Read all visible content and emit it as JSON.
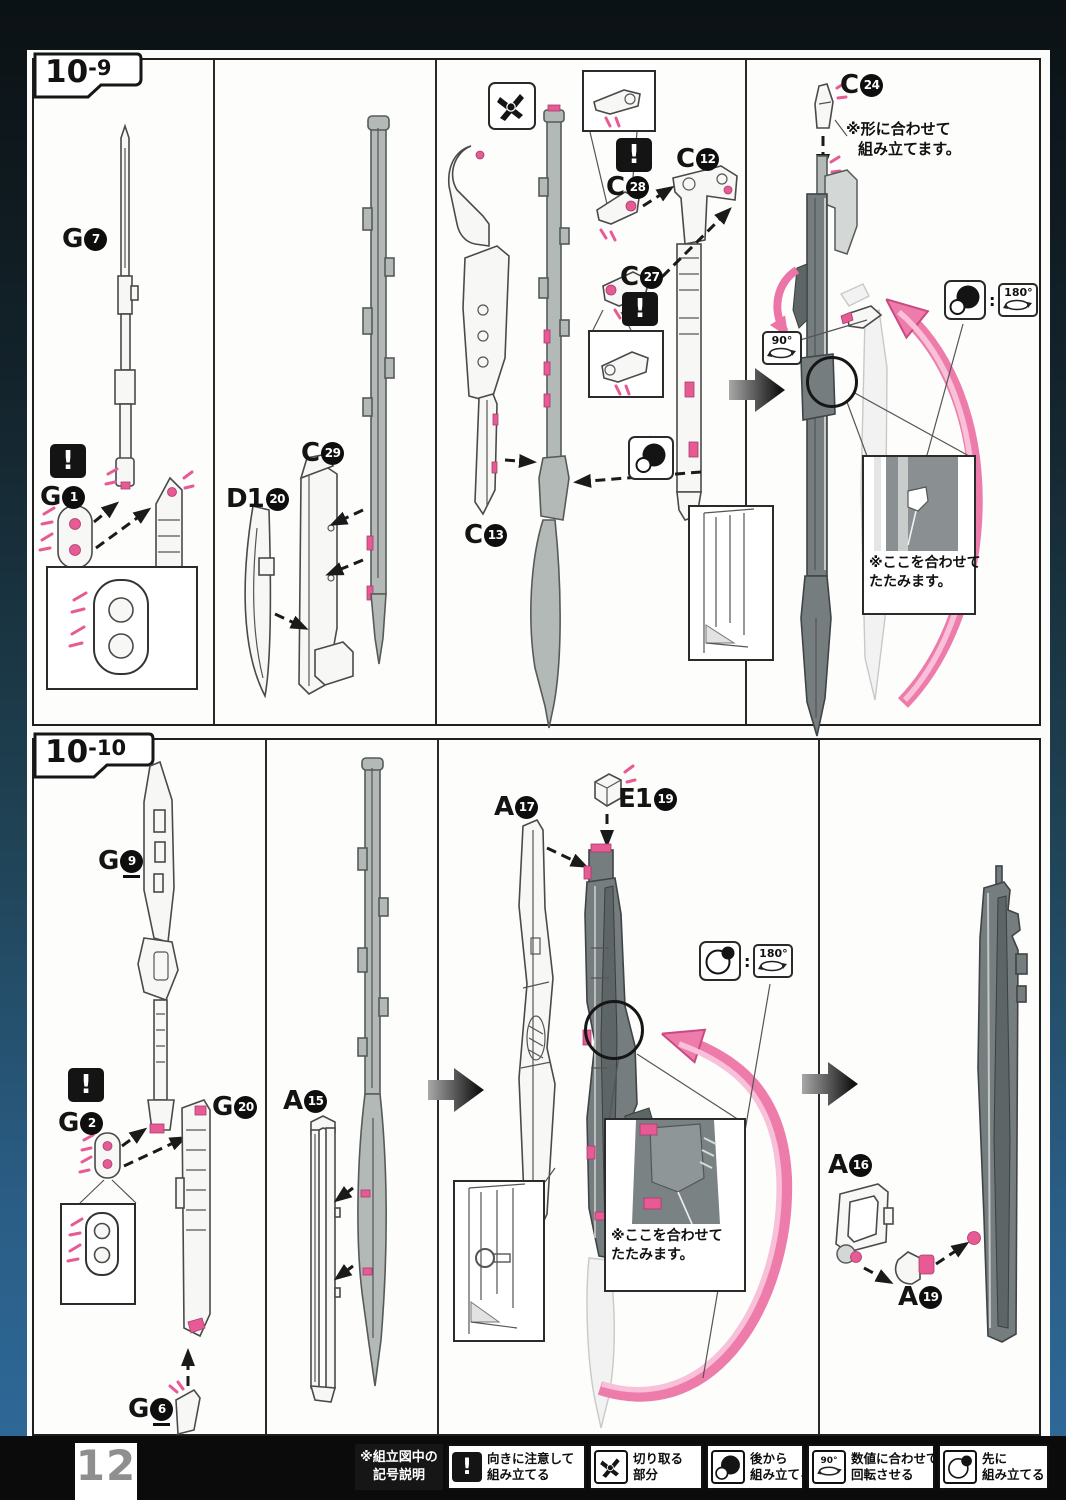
{
  "colors": {
    "accent_pink": "#e75a94",
    "pink_light": "#f9c0d9",
    "part_gray": "#b3b9b7",
    "part_dark": "#767d7f",
    "ink": "#1a1a1a",
    "page_bg": "#fbfbfa",
    "frame_blue": "#2a5d85"
  },
  "icons": {
    "warning_glyph": "!",
    "colon": ":"
  },
  "steps": {
    "s1": {
      "label": {
        "main": "10",
        "sub": "-9"
      },
      "parts": {
        "g7": {
          "letter": "G",
          "num": "7"
        },
        "g1": {
          "letter": "G",
          "num": "1"
        },
        "g27": {
          "letter": "G",
          "num": "27"
        },
        "d120": {
          "letter": "D1",
          "num": "20"
        },
        "c29": {
          "letter": "C",
          "num": "29"
        },
        "c13": {
          "letter": "C",
          "num": "13"
        },
        "c28": {
          "letter": "C",
          "num": "28"
        },
        "c12": {
          "letter": "C",
          "num": "12"
        },
        "c27": {
          "letter": "C",
          "num": "27"
        },
        "c24": {
          "letter": "C",
          "num": "24"
        }
      },
      "notes": {
        "fit_l1": "※形に合わせて",
        "fit_l2": "組み立てます。",
        "fold_l1": "※ここを合わせて",
        "fold_l2": "たたみます。"
      },
      "rot90": "90°",
      "rot180": "180°"
    },
    "s2": {
      "label": {
        "main": "10",
        "sub": "-10"
      },
      "parts": {
        "g9": {
          "letter": "G",
          "num": "9"
        },
        "g2": {
          "letter": "G",
          "num": "2"
        },
        "g20": {
          "letter": "G",
          "num": "20"
        },
        "g6": {
          "letter": "G",
          "num": "6"
        },
        "a15": {
          "letter": "A",
          "num": "15"
        },
        "a17": {
          "letter": "A",
          "num": "17"
        },
        "e119": {
          "letter": "E1",
          "num": "19"
        },
        "a16": {
          "letter": "A",
          "num": "16"
        },
        "a19": {
          "letter": "A",
          "num": "19"
        }
      },
      "notes": {
        "fold_l1": "※ここを合わせて",
        "fold_l2": "たたみます。"
      },
      "rot180": "180°"
    }
  },
  "legend": {
    "title_l1": "※組立図中の",
    "title_l2": "記号説明",
    "items": [
      {
        "name": "warning",
        "l1": "向きに注意して",
        "l2": "組み立てる"
      },
      {
        "name": "cut",
        "l1": "切り取る",
        "l2": "部分"
      },
      {
        "name": "assemble-later",
        "l1": "後から",
        "l2": "組み立てる"
      },
      {
        "name": "rotate",
        "label": "90°",
        "l1": "数値に合わせて",
        "l2": "回転させる"
      },
      {
        "name": "assemble-first",
        "l1": "先に",
        "l2": "組み立てる"
      }
    ]
  },
  "footer": {
    "page_number": "12"
  }
}
